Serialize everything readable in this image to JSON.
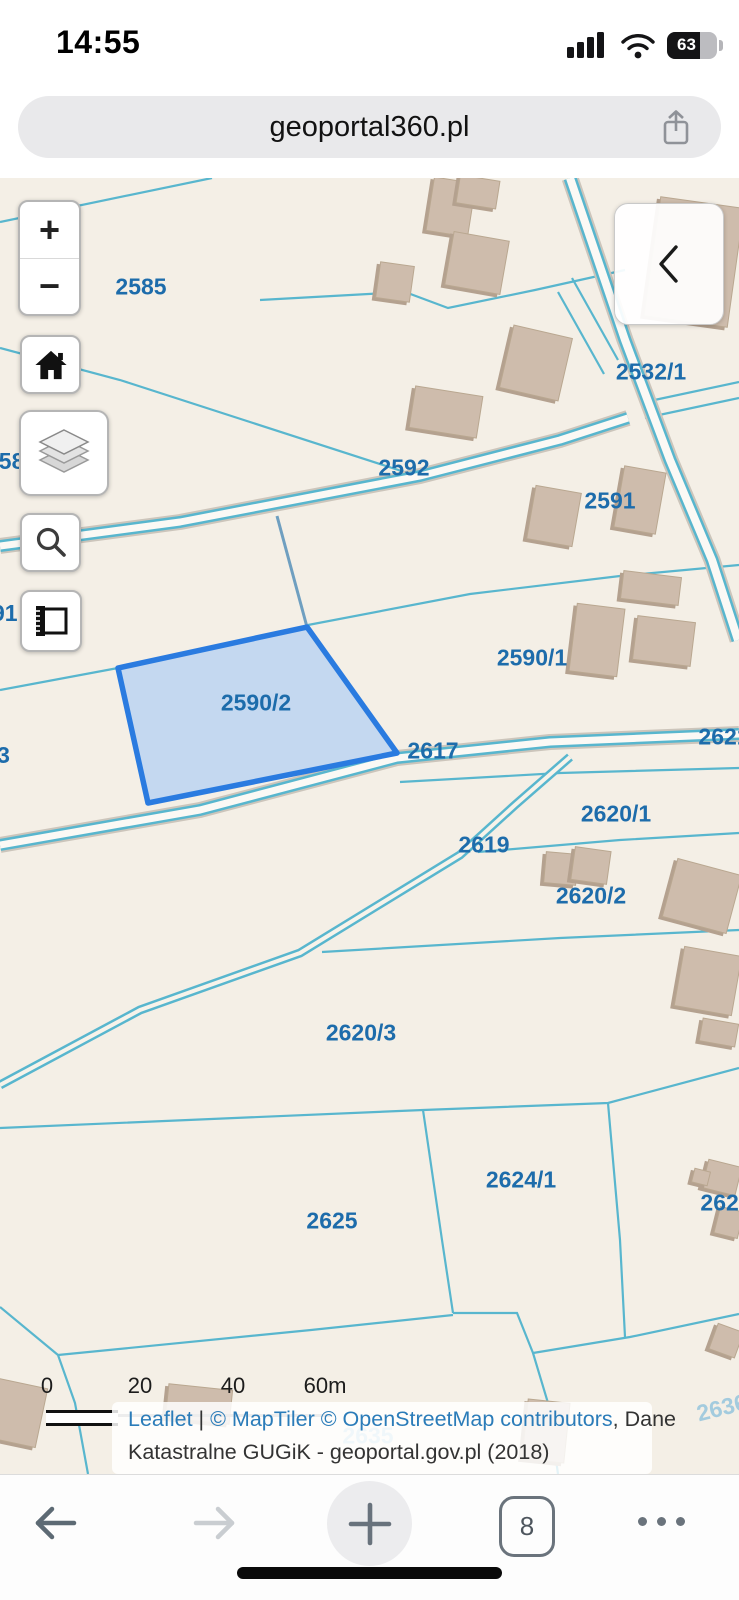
{
  "status_bar": {
    "time": "14:55",
    "battery_percent": "63"
  },
  "address_bar": {
    "url": "geoportal360.pl"
  },
  "colors": {
    "map_background": "#f4efe6",
    "parcel_line": "#58b6ce",
    "label_blue": "#1d6cab",
    "highlight_stroke": "#2a7be0",
    "highlight_fill": "#b8d2f2",
    "building": "#cebcac",
    "link_blue": "#2b7cb9",
    "faint_label": "#a3cbde"
  },
  "map": {
    "controls": {
      "zoom_in": "+",
      "zoom_out": "−"
    },
    "labels": [
      {
        "text": "2585"
      },
      {
        "text": "2532/1"
      },
      {
        "text": "2592"
      },
      {
        "text": "2591"
      },
      {
        "text": "2590/1"
      },
      {
        "text": "2590/2"
      },
      {
        "text": "2617"
      },
      {
        "text": "2621"
      },
      {
        "text": "258"
      },
      {
        "text": "91"
      },
      {
        "text": "0/3"
      },
      {
        "text": "2620/1"
      },
      {
        "text": "2619"
      },
      {
        "text": "2620/2"
      },
      {
        "text": "2620/3"
      },
      {
        "text": "2624/1"
      },
      {
        "text": "2625"
      },
      {
        "text": "2624"
      },
      {
        "text": "2636"
      },
      {
        "text": "2635"
      }
    ],
    "scale_bar": {
      "ticks": [
        "0",
        "20",
        "40",
        "60m"
      ]
    },
    "attribution": {
      "leaflet": "Leaflet",
      "sep": " | ",
      "maptiler": "© MapTiler",
      "osm": " © OpenStreetMap contributors",
      "dane": ", Dane",
      "line2": "Katastralne GUGiK - geoportal.gov.pl (2018)"
    }
  },
  "toolbar": {
    "tab_count": "8"
  }
}
